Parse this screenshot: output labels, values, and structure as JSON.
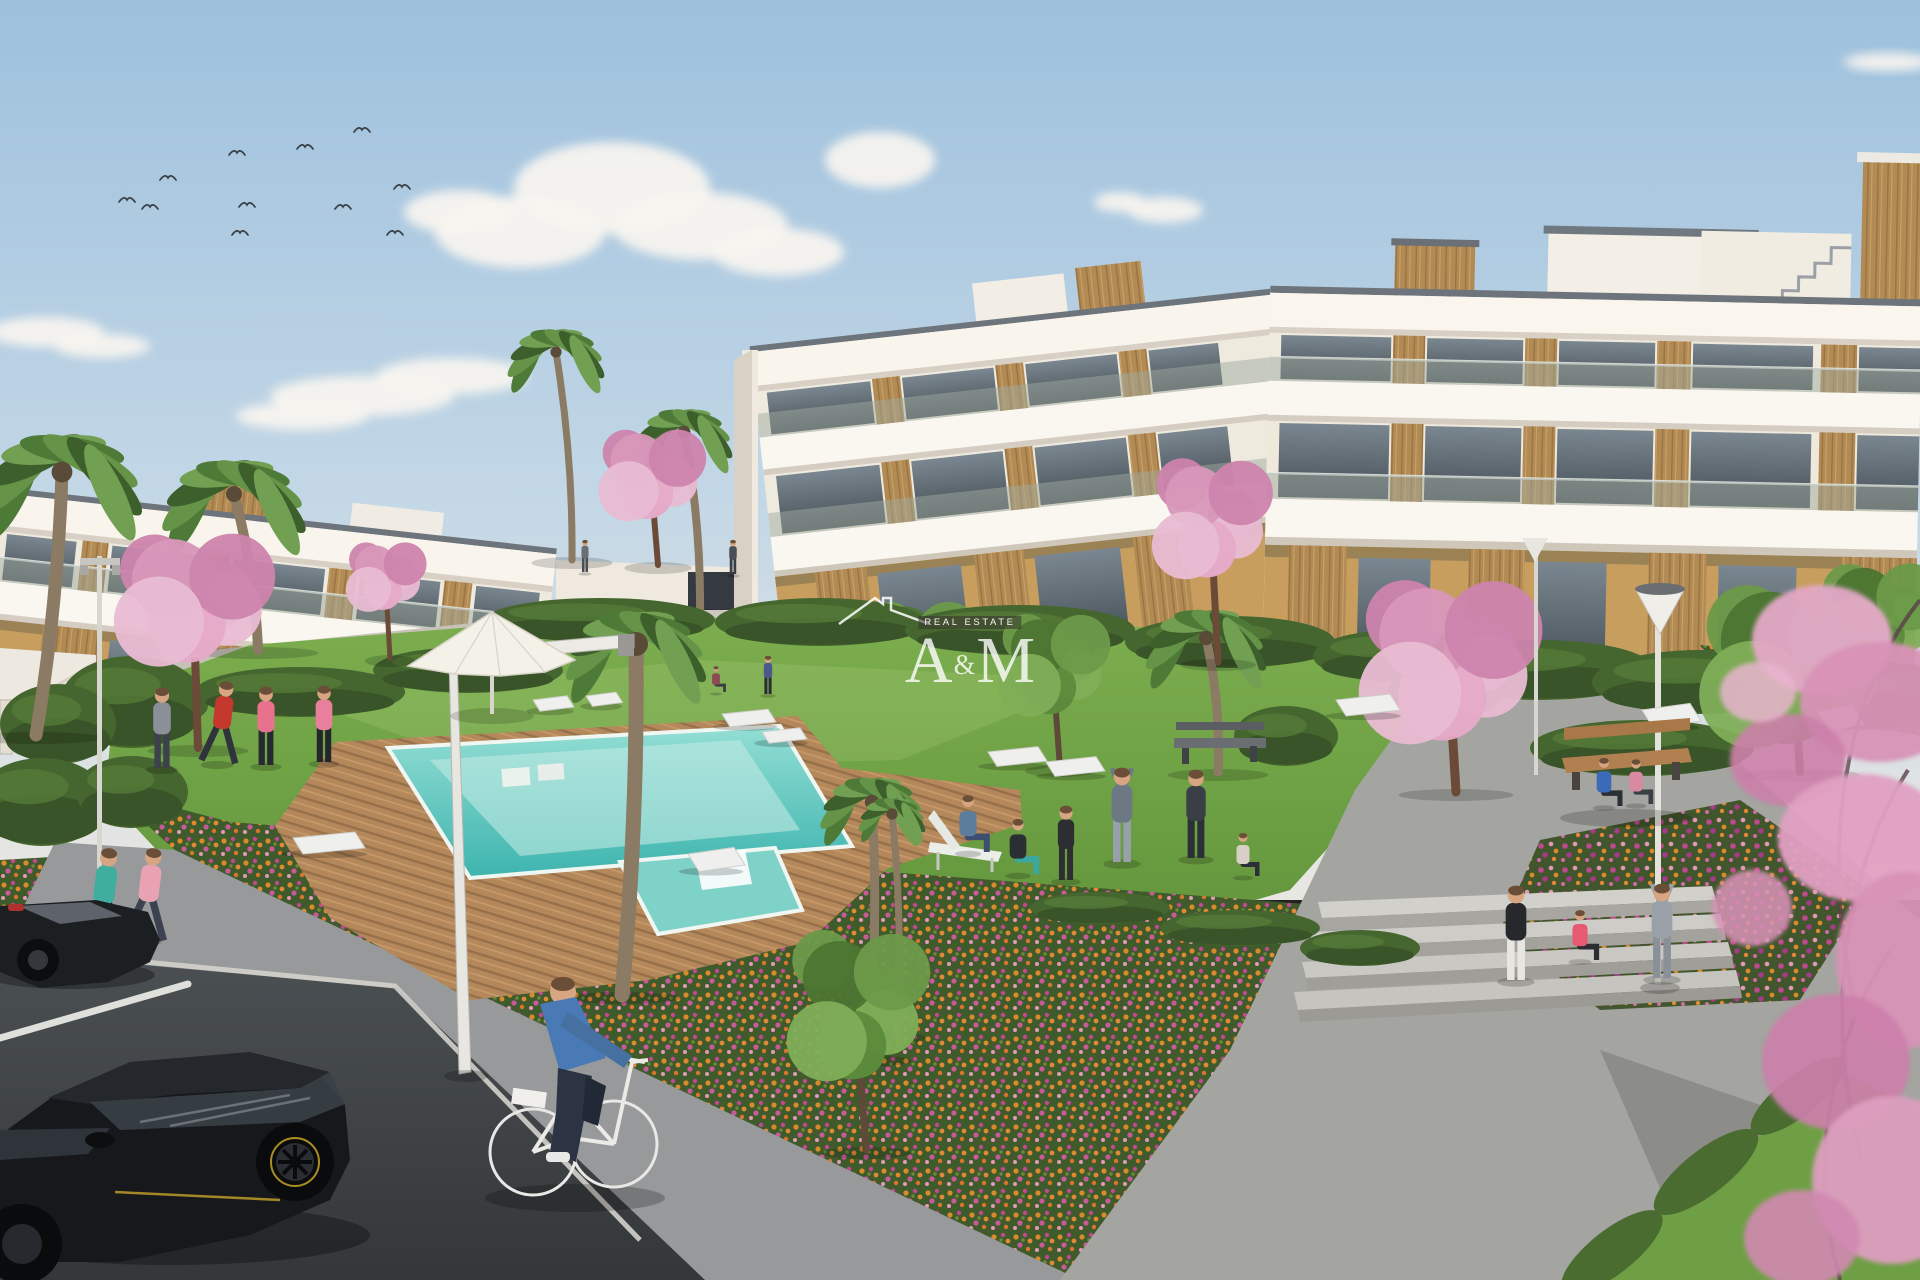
{
  "meta": {
    "title": "Residential complex exterior rendering with pool and gardens",
    "kind": "photorealistic architectural render"
  },
  "watermark": {
    "monogram_left": "A",
    "monogram_amp": "&",
    "monogram_right": "M",
    "subtitle": "REAL ESTATE"
  },
  "palette": {
    "sky_top": "#9dc0dd",
    "sky_horizon": "#e9e7e2",
    "building_white": "#f6f2ea",
    "wood_accent": "#b28a54",
    "ochre_wall": "#c79e5e",
    "glass": "#55616a",
    "lawn": "#6d9e43",
    "pool_water": "#4fc2ba",
    "deck_wood": "#b4885b",
    "flower_orange": "#d98a2b",
    "flower_magenta": "#c2498f",
    "blossom_pink": "#dfa2c2",
    "plaza": "#c6c2b8",
    "path_gray": "#97999a",
    "plaza_path": "#a4a4a0",
    "asphalt": "#45494c",
    "hedge_green": "#46662f"
  },
  "sky": {
    "clouds": [
      {
        "puffs": [
          [
            520,
            232,
            85,
            36
          ],
          [
            612,
            188,
            98,
            46
          ],
          [
            700,
            226,
            88,
            34
          ],
          [
            778,
            252,
            66,
            24
          ],
          [
            460,
            212,
            56,
            22
          ],
          [
            880,
            160,
            55,
            28
          ]
        ]
      },
      {
        "puffs": [
          [
            362,
            396,
            92,
            20
          ],
          [
            452,
            376,
            76,
            18
          ],
          [
            302,
            416,
            66,
            14
          ]
        ]
      },
      {
        "puffs": [
          [
            46,
            332,
            58,
            15
          ],
          [
            102,
            346,
            48,
            12
          ]
        ]
      },
      {
        "puffs": [
          [
            1165,
            210,
            38,
            13
          ],
          [
            1120,
            202,
            26,
            10
          ]
        ]
      },
      {
        "puffs": [
          [
            1888,
            62,
            44,
            9
          ]
        ]
      }
    ],
    "birds": [
      [
        127,
        200
      ],
      [
        150,
        207
      ],
      [
        168,
        178
      ],
      [
        237,
        153
      ],
      [
        247,
        205
      ],
      [
        240,
        233
      ],
      [
        305,
        147
      ],
      [
        343,
        207
      ],
      [
        362,
        130
      ],
      [
        402,
        187
      ],
      [
        395,
        233
      ]
    ]
  },
  "scene": {
    "trees": [
      {
        "kind": "palm",
        "layer": "back",
        "x": 572,
        "y": 560,
        "cx": 556,
        "cy": 352,
        "r": 58,
        "tw": 7
      },
      {
        "kind": "palm",
        "layer": "back",
        "x": 700,
        "y": 612,
        "cx": 684,
        "cy": 432,
        "r": 58,
        "tw": 8
      },
      {
        "kind": "cherry",
        "layer": "back",
        "x": 658,
        "y": 565,
        "cx": 652,
        "cy": 474,
        "rx": 48,
        "ry": 44,
        "tw": 6
      },
      {
        "kind": "green",
        "layer": "back",
        "x": 925,
        "y": 726,
        "cx": 920,
        "cy": 652,
        "rx": 54,
        "ry": 50,
        "tw": 6
      },
      {
        "kind": "palm",
        "layer": "mid",
        "x": 36,
        "y": 735,
        "cx": 62,
        "cy": 472,
        "r": 96,
        "tw": 13
      },
      {
        "kind": "palm",
        "layer": "mid",
        "x": 258,
        "y": 650,
        "cx": 234,
        "cy": 494,
        "r": 86,
        "tw": 10
      },
      {
        "kind": "cherry",
        "layer": "mid",
        "x": 198,
        "y": 748,
        "cx": 194,
        "cy": 598,
        "rx": 72,
        "ry": 60,
        "tw": 8
      },
      {
        "kind": "cherry",
        "layer": "mid",
        "x": 390,
        "y": 658,
        "cx": 386,
        "cy": 576,
        "rx": 36,
        "ry": 34,
        "tw": 5
      },
      {
        "kind": "palm",
        "layer": "mid",
        "x": 622,
        "y": 995,
        "cx": 636,
        "cy": 644,
        "r": 84,
        "tw": 15
      },
      {
        "kind": "palm",
        "layer": "mid",
        "x": 868,
        "y": 1058,
        "cx": 872,
        "cy": 802,
        "r": 62,
        "tw": 9
      },
      {
        "kind": "palm",
        "layer": "mid",
        "x": 897,
        "y": 1035,
        "cx": 892,
        "cy": 814,
        "r": 40,
        "tw": 7
      },
      {
        "kind": "palm",
        "layer": "mid",
        "x": 1218,
        "y": 772,
        "cx": 1206,
        "cy": 638,
        "r": 72,
        "tw": 9
      },
      {
        "kind": "cherry",
        "layer": "mid",
        "x": 1218,
        "y": 662,
        "cx": 1212,
        "cy": 518,
        "rx": 54,
        "ry": 70,
        "tw": 7
      },
      {
        "kind": "cherry",
        "layer": "mid",
        "x": 1456,
        "y": 792,
        "cx": 1450,
        "cy": 660,
        "rx": 82,
        "ry": 84,
        "tw": 9
      },
      {
        "kind": "green",
        "layer": "mid",
        "x": 1060,
        "y": 768,
        "cx": 1054,
        "cy": 664,
        "rx": 50,
        "ry": 54,
        "tw": 6
      },
      {
        "kind": "green",
        "layer": "mid",
        "x": 866,
        "y": 1150,
        "cx": 858,
        "cy": 1005,
        "rx": 64,
        "ry": 92,
        "tw": 7
      },
      {
        "kind": "green",
        "layer": "mid",
        "x": 1800,
        "y": 772,
        "cx": 1795,
        "cy": 664,
        "rx": 86,
        "ry": 78,
        "tw": 8
      },
      {
        "kind": "green",
        "layer": "mid",
        "x": 1884,
        "y": 665,
        "cx": 1880,
        "cy": 614,
        "rx": 56,
        "ry": 48,
        "tw": 6
      }
    ],
    "hedges": [
      {
        "cx": 600,
        "cy": 620,
        "rx": 115,
        "ry": 22
      },
      {
        "cx": 820,
        "cy": 622,
        "rx": 105,
        "ry": 24
      },
      {
        "cx": 1020,
        "cy": 630,
        "rx": 115,
        "ry": 25
      },
      {
        "cx": 1230,
        "cy": 642,
        "rx": 105,
        "ry": 26
      },
      {
        "cx": 1398,
        "cy": 656,
        "rx": 85,
        "ry": 26
      },
      {
        "cx": 1540,
        "cy": 670,
        "rx": 115,
        "ry": 30
      },
      {
        "cx": 1700,
        "cy": 682,
        "rx": 108,
        "ry": 32
      },
      {
        "cx": 1856,
        "cy": 696,
        "rx": 100,
        "ry": 34
      },
      {
        "cx": 120,
        "cy": 706,
        "rx": 88,
        "ry": 26
      },
      {
        "cx": 300,
        "cy": 692,
        "rx": 105,
        "ry": 25
      },
      {
        "cx": 468,
        "cy": 670,
        "rx": 95,
        "ry": 23
      },
      {
        "cx": 132,
        "cy": 702,
        "rx": 72,
        "ry": 46
      },
      {
        "cx": 58,
        "cy": 724,
        "rx": 58,
        "ry": 40
      },
      {
        "cx": 42,
        "cy": 802,
        "rx": 66,
        "ry": 44
      },
      {
        "cx": 132,
        "cy": 792,
        "rx": 56,
        "ry": 36
      },
      {
        "cx": 1286,
        "cy": 736,
        "rx": 52,
        "ry": 30
      },
      {
        "cx": 1642,
        "cy": 748,
        "rx": 112,
        "ry": 28
      },
      {
        "cx": 1446,
        "cy": 692,
        "rx": 58,
        "ry": 26
      },
      {
        "cx": 1100,
        "cy": 908,
        "rx": 70,
        "ry": 16
      },
      {
        "cx": 1240,
        "cy": 928,
        "rx": 80,
        "ry": 18
      },
      {
        "cx": 1360,
        "cy": 948,
        "rx": 60,
        "ry": 18
      }
    ],
    "loungers": [
      [
        533,
        700,
        34,
        14
      ],
      [
        586,
        696,
        30,
        13
      ],
      [
        722,
        714,
        46,
        16
      ],
      [
        762,
        732,
        38,
        14
      ],
      [
        293,
        838,
        62,
        20
      ],
      [
        688,
        854,
        46,
        22
      ],
      [
        988,
        752,
        50,
        18
      ],
      [
        1046,
        762,
        50,
        18
      ],
      [
        1336,
        700,
        54,
        20
      ],
      [
        1642,
        710,
        48,
        22
      ],
      [
        1818,
        712,
        34,
        24
      ]
    ],
    "people": [
      {
        "label": "jogger-teal",
        "x": 98,
        "y": 944,
        "h": 96,
        "shirt": "#3fae9e",
        "pants": "#262a30",
        "pose": "jog"
      },
      {
        "label": "jogger-pink",
        "x": 143,
        "y": 940,
        "h": 92,
        "shirt": "#e8a2b2",
        "pants": "#3c4250",
        "pose": "jog"
      },
      {
        "label": "exerciser-gray",
        "x": 162,
        "y": 768,
        "h": 80,
        "shirt": "#8a8f98",
        "pants": "#3c414b",
        "pose": "stand"
      },
      {
        "label": "exerciser-red",
        "x": 217,
        "y": 763,
        "h": 82,
        "shirt": "#c4382e",
        "pants": "#2f343c",
        "pose": "jog"
      },
      {
        "label": "exerciser-pink",
        "x": 266,
        "y": 765,
        "h": 78,
        "shirt": "#e8728e",
        "pants": "#26292f",
        "pose": "stand"
      },
      {
        "label": "walker-pink",
        "x": 324,
        "y": 762,
        "h": 76,
        "shirt": "#e87f9d",
        "pants": "#23262b",
        "pose": "stand"
      },
      {
        "label": "man-deckchair",
        "x": 968,
        "y": 852,
        "h": 66,
        "shirt": "#5d7d9d",
        "pants": "#3e4e6e",
        "pose": "sit"
      },
      {
        "label": "woman-squatting",
        "x": 1018,
        "y": 874,
        "h": 64,
        "shirt": "#2b2f33",
        "pants": "#3aa8a0",
        "pose": "sit"
      },
      {
        "label": "person-tracksuit",
        "x": 1066,
        "y": 880,
        "h": 74,
        "shirt": "#2c2e32",
        "pants": "#2c2e32",
        "pose": "stand"
      },
      {
        "label": "man-stretching",
        "x": 1122,
        "y": 862,
        "h": 94,
        "shirt": "#6d7885",
        "pants": "#98a0ac",
        "pose": "stretch"
      },
      {
        "label": "man-dark-shorts",
        "x": 1196,
        "y": 858,
        "h": 88,
        "shirt": "#3a3f47",
        "pants": "#2b3038",
        "pose": "stand"
      },
      {
        "label": "woman-meditating",
        "x": 1243,
        "y": 876,
        "h": 50,
        "shirt": "#d8cfc6",
        "pants": "#2b2f36",
        "pose": "sit"
      },
      {
        "label": "woman-standing-right",
        "x": 1516,
        "y": 980,
        "h": 94,
        "shirt": "#26282c",
        "pants": "#e8e6e2",
        "pose": "stand"
      },
      {
        "label": "woman-sitting-steps",
        "x": 1580,
        "y": 960,
        "h": 58,
        "shirt": "#e85a72",
        "pants": "#2b2d33",
        "pose": "sit"
      },
      {
        "label": "person-hoodie-arms-up",
        "x": 1662,
        "y": 978,
        "h": 94,
        "shirt": "#9aa0a8",
        "pants": "#8a9098",
        "pose": "stretch"
      },
      {
        "label": "bench-man",
        "x": 1604,
        "y": 806,
        "h": 56,
        "shirt": "#3a6ab8",
        "pants": "#2b2f36",
        "pose": "sit"
      },
      {
        "label": "bench-woman",
        "x": 1636,
        "y": 804,
        "h": 52,
        "shirt": "#d88aa0",
        "pants": "#3a3f45",
        "pose": "sit"
      },
      {
        "label": "balcony-figure",
        "x": 733,
        "y": 574,
        "h": 34,
        "shirt": "#4a4e55",
        "pants": "#3a3d42",
        "pose": "stand"
      },
      {
        "label": "plaza-figure",
        "x": 585,
        "y": 572,
        "h": 32,
        "shirt": "#6a6e75",
        "pants": "#4a4d52",
        "pose": "stand"
      },
      {
        "label": "bg-child-sitting",
        "x": 716,
        "y": 692,
        "h": 30,
        "shirt": "#8a4a52",
        "pants": "#3a3d42",
        "pose": "sit"
      },
      {
        "label": "bg-woman-standing",
        "x": 768,
        "y": 694,
        "h": 38,
        "shirt": "#4a5a8a",
        "pants": "#2b2e33",
        "pose": "stand"
      }
    ]
  }
}
